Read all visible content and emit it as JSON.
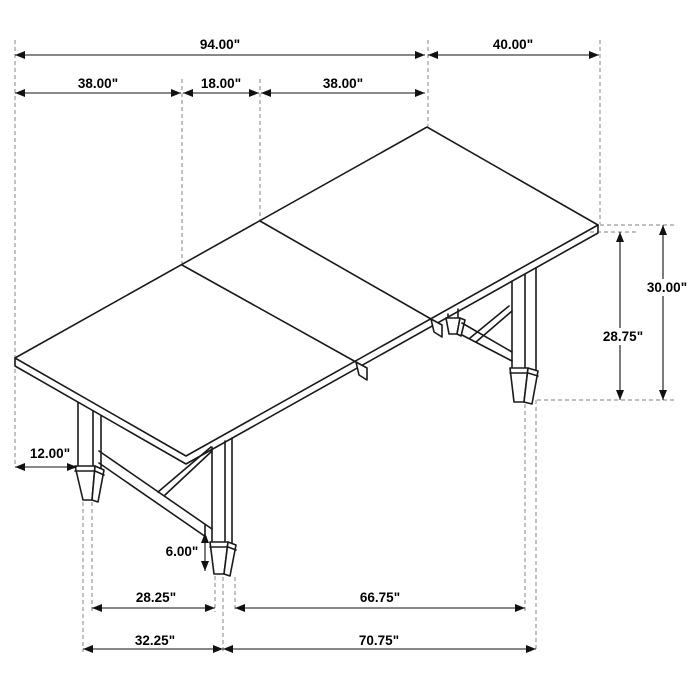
{
  "drawing": {
    "product": "rectangular dining table with extension leaf and trestle base",
    "view": "isometric dimension drawing",
    "units": "inches",
    "background": "#ffffff",
    "line_color": "#1a1a1a",
    "dimension_color": "#111111",
    "extension_line_color": "#999999"
  },
  "labels": {
    "overall_length": "94.00\"",
    "width": "40.00\"",
    "left_section": "38.00\"",
    "leaf_section": "18.00\"",
    "right_section": "38.00\"",
    "height": "30.00\"",
    "underside_height": "28.75\"",
    "leg_inset": "12.00\"",
    "stretcher_clearance": "6.00\"",
    "inner_leg_span": "28.25\"",
    "right_leg_span": "66.75\"",
    "left_base_span": "32.25\"",
    "right_base_span": "70.75\""
  },
  "measurements": [
    {
      "name": "overall-length",
      "inches": 94.0
    },
    {
      "name": "width",
      "inches": 40.0
    },
    {
      "name": "left-section",
      "inches": 38.0
    },
    {
      "name": "leaf-section",
      "inches": 18.0
    },
    {
      "name": "right-section",
      "inches": 38.0
    },
    {
      "name": "height",
      "inches": 30.0
    },
    {
      "name": "underside-height",
      "inches": 28.75
    },
    {
      "name": "leg-inset",
      "inches": 12.0
    },
    {
      "name": "stretcher-clearance",
      "inches": 6.0
    },
    {
      "name": "inner-leg-span",
      "inches": 28.25
    },
    {
      "name": "right-leg-span",
      "inches": 66.75
    },
    {
      "name": "left-base-span",
      "inches": 32.25
    },
    {
      "name": "right-base-span",
      "inches": 70.75
    }
  ]
}
